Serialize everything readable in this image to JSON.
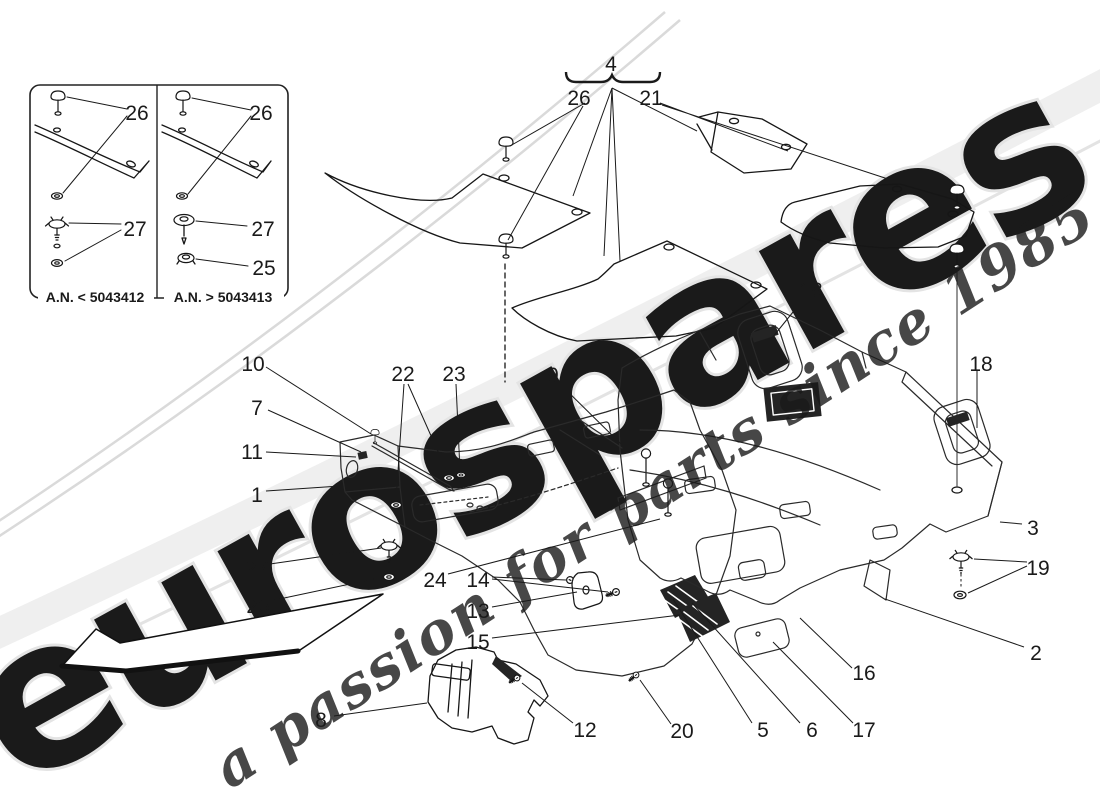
{
  "page": {
    "background": "#ffffff",
    "ink": "#1a1a1a"
  },
  "inset_panel": {
    "caption_left": "A.N. < 5043412",
    "caption_right": "A.N. > 5043413",
    "label_pin": "26",
    "label_clip": "27",
    "label_ring": "25"
  },
  "callouts": {
    "mat_set": "4",
    "front_pins": "26",
    "rear_mats": "21",
    "handle_center": "18",
    "handle_right": "18",
    "screw_10": "10",
    "studs_22": "22",
    "stud_23": "23",
    "bracket_9": "9",
    "bracket_7": "7",
    "clip_11": "11",
    "side_wall_1": "1",
    "trim_3": "3",
    "clip_27": "27",
    "clip_19": "19",
    "rod_24": "24",
    "screws_14": "14",
    "ring_25": "25",
    "bracket_13": "13",
    "edge_15": "15",
    "carpet_2": "2",
    "rail_16": "16",
    "insulation_8": "8",
    "screw_12": "12",
    "screw_20": "20",
    "vent_5": "5",
    "vent_6": "6",
    "plate_17": "17"
  },
  "watermark": {
    "brand": "eurospares",
    "tagline": "a passion for parts since 1985",
    "brand_fill": "#fcfcfc",
    "brand_stroke": "#e4e4e4",
    "tagline_fill": "#ece282",
    "band_color": "#efefef"
  }
}
